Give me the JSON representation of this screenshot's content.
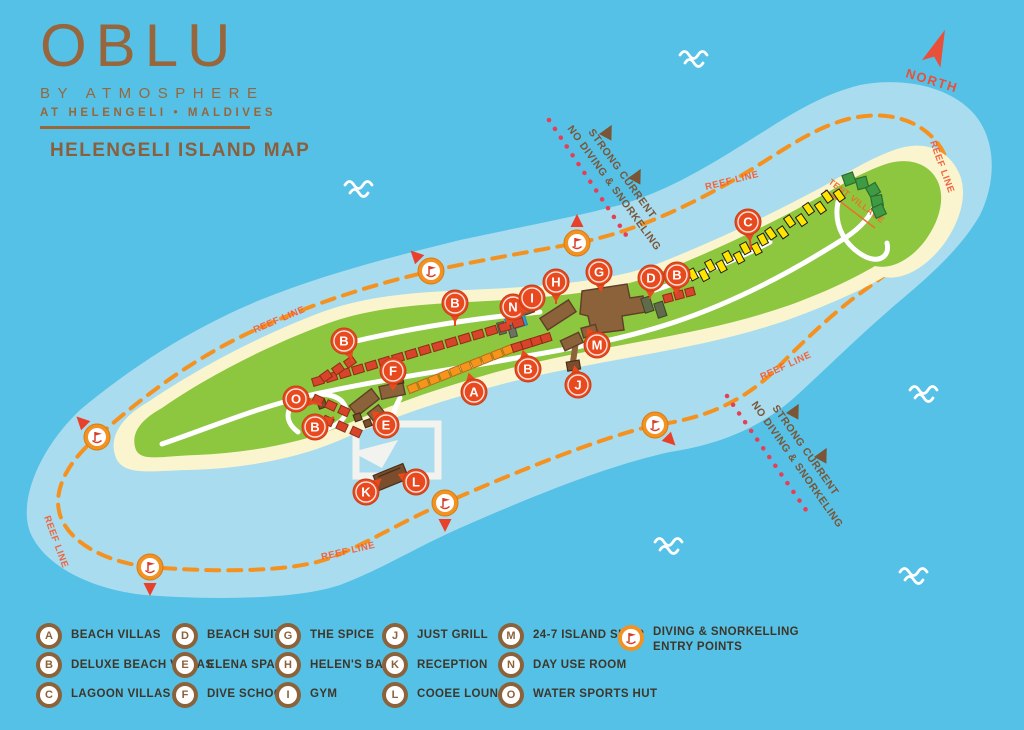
{
  "colors": {
    "ocean": "#55C1E7",
    "lagoon": "#A9DCEE",
    "island_green": "#8DC63F",
    "beach": "#FAF4CF",
    "building_brown": "#8B6239",
    "logo_brown": "#97663C",
    "marker_red": "#E8491F",
    "entry_orange": "#F29222",
    "reef_orange": "#F5921F",
    "warning_red": "#E63E56",
    "warning_brown": "#7A5536",
    "villa_red": "#D8432B",
    "villa_orange": "#F7941D",
    "villa_yellow": "#FFE400",
    "tent_green": "#3F9A44",
    "pool_blue": "#2D9FD8",
    "north_red": "#E8503A",
    "legend_text": "#3E3629",
    "reef_label_color": "#F0633C"
  },
  "logo": {
    "brand": "OBLU",
    "line1": "BY ATMOSPHERE",
    "line2": "AT HELENGELI • MALDIVES",
    "map_title": "HELENGELI ISLAND MAP"
  },
  "compass": {
    "label": "NORTH"
  },
  "map": {
    "reef_label": "REEF LINE",
    "tent_village_label": "TENT VILLAGE",
    "warning": {
      "line1": "STRONG CURRENT",
      "line2": "NO DIVING & SNORKELING"
    },
    "markers": [
      {
        "letter": "O",
        "x": 296,
        "y": 399,
        "tx": 322,
        "ty": 405
      },
      {
        "letter": "B",
        "x": 315,
        "y": 427,
        "tx": 334,
        "ty": 417
      },
      {
        "letter": "B",
        "x": 344,
        "y": 341,
        "tx": 353,
        "ty": 362
      },
      {
        "letter": "E",
        "x": 386,
        "y": 425,
        "tx": 372,
        "ty": 411
      },
      {
        "letter": "F",
        "x": 393,
        "y": 371,
        "tx": 393,
        "ty": 387
      },
      {
        "letter": "B",
        "x": 455,
        "y": 303,
        "tx": 455,
        "ty": 326
      },
      {
        "letter": "A",
        "x": 474,
        "y": 392,
        "tx": 469,
        "ty": 374
      },
      {
        "letter": "B",
        "x": 528,
        "y": 369,
        "tx": 523,
        "ty": 351
      },
      {
        "letter": "N",
        "x": 513,
        "y": 307,
        "tx": 508,
        "ty": 325
      },
      {
        "letter": "I",
        "x": 532,
        "y": 298,
        "tx": 521,
        "ty": 314
      },
      {
        "letter": "H",
        "x": 556,
        "y": 282,
        "tx": 556,
        "ty": 304
      },
      {
        "letter": "G",
        "x": 599,
        "y": 272,
        "tx": 601,
        "ty": 291
      },
      {
        "letter": "M",
        "x": 597,
        "y": 345,
        "tx": 590,
        "ty": 333
      },
      {
        "letter": "J",
        "x": 578,
        "y": 385,
        "tx": 575,
        "ty": 369
      },
      {
        "letter": "D",
        "x": 651,
        "y": 278,
        "tx": 650,
        "ty": 299
      },
      {
        "letter": "B",
        "x": 677,
        "y": 275,
        "tx": 676,
        "ty": 294
      },
      {
        "letter": "C",
        "x": 748,
        "y": 222,
        "tx": 751,
        "ty": 250
      },
      {
        "letter": "K",
        "x": 366,
        "y": 492,
        "tx": 381,
        "ty": 479
      },
      {
        "letter": "L",
        "x": 416,
        "y": 482,
        "tx": 402,
        "ty": 476
      }
    ],
    "entry_points": [
      {
        "x": 431,
        "y": 271,
        "arrow_deg": 315
      },
      {
        "x": 577,
        "y": 243,
        "arrow_deg": 0
      },
      {
        "x": 97,
        "y": 437,
        "arrow_deg": 315
      },
      {
        "x": 150,
        "y": 567,
        "arrow_deg": 180
      },
      {
        "x": 445,
        "y": 503,
        "arrow_deg": 180
      },
      {
        "x": 655,
        "y": 425,
        "arrow_deg": 135
      }
    ],
    "reef_labels": [
      {
        "x": 255,
        "y": 333,
        "deg": -23
      },
      {
        "x": 322,
        "y": 560,
        "deg": -13
      },
      {
        "x": 706,
        "y": 190,
        "deg": -14
      },
      {
        "x": 930,
        "y": 142,
        "deg": 70
      },
      {
        "x": 762,
        "y": 380,
        "deg": -25
      },
      {
        "x": 44,
        "y": 517,
        "deg": 70
      }
    ]
  },
  "legend": {
    "items": [
      {
        "letter": "A",
        "label": "BEACH VILLAS"
      },
      {
        "letter": "B",
        "label": "DELUXE BEACH VILLAS"
      },
      {
        "letter": "C",
        "label": "LAGOON VILLAS"
      },
      {
        "letter": "D",
        "label": "BEACH SUITES"
      },
      {
        "letter": "E",
        "label": "ELENA SPA"
      },
      {
        "letter": "F",
        "label": "DIVE SCHOOL"
      },
      {
        "letter": "G",
        "label": "THE SPICE"
      },
      {
        "letter": "H",
        "label": "HELEN'S BAR"
      },
      {
        "letter": "I",
        "label": "GYM"
      },
      {
        "letter": "J",
        "label": "JUST GRILL"
      },
      {
        "letter": "K",
        "label": "RECEPTION"
      },
      {
        "letter": "L",
        "label": "COOEE LOUNGE"
      },
      {
        "letter": "M",
        "label": "24-7 ISLAND SHOP"
      },
      {
        "letter": "N",
        "label": "DAY USE ROOM"
      },
      {
        "letter": "O",
        "label": "WATER SPORTS HUT"
      }
    ],
    "entry_label_line1": "DIVING & SNORKELLING",
    "entry_label_line2": "ENTRY POINTS"
  }
}
